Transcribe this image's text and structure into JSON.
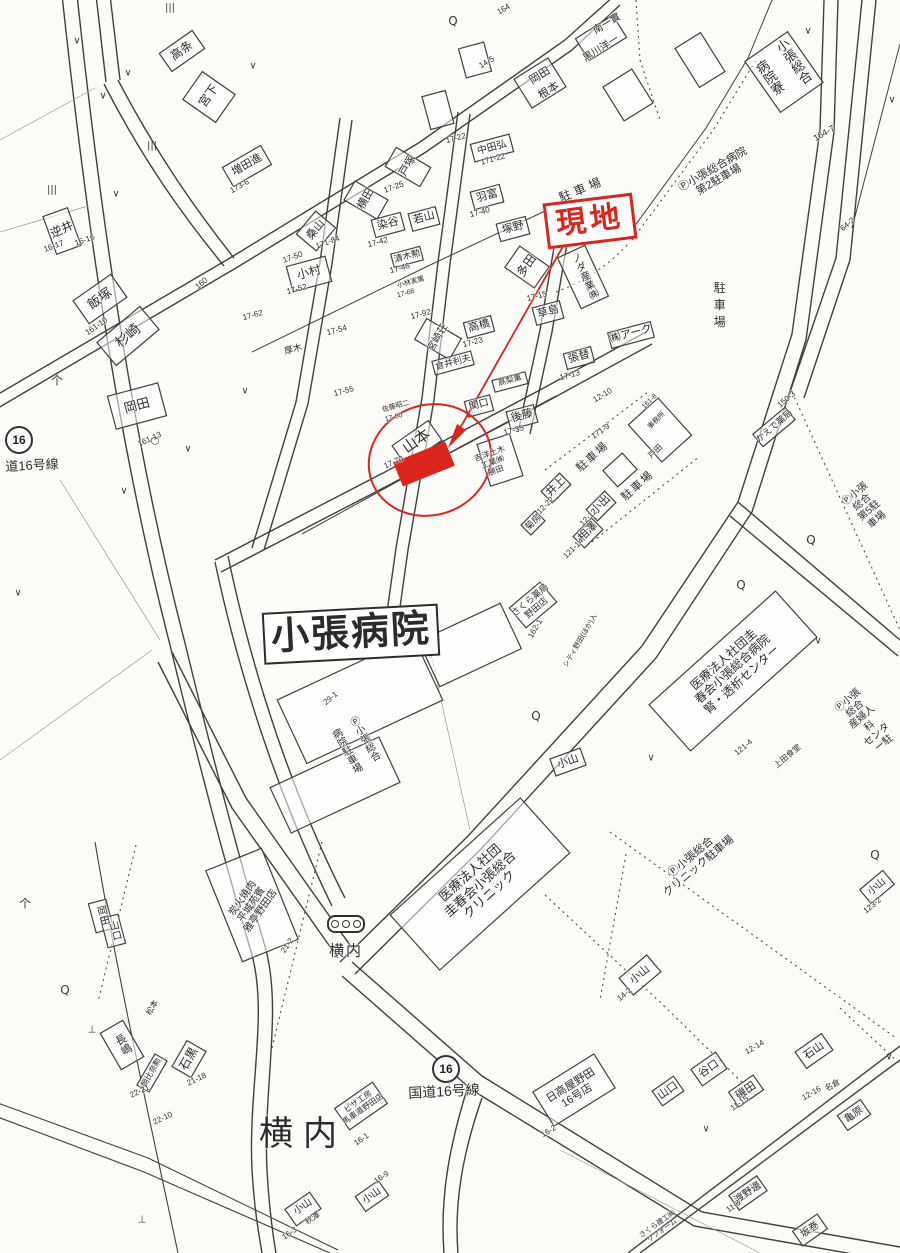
{
  "title": "住宅地図(案内図) 現地周辺図",
  "colors": {
    "annotation_red": "#d9251c",
    "line": "#3f3f3c",
    "paper": "#fbfbf8"
  },
  "annotation": {
    "site_label": "現地"
  },
  "roads": {
    "route_shield": "16",
    "route_label_bottom": "国道16号線",
    "route_label_left": "道16号線"
  },
  "map": {
    "labels": [
      {
        "t": "飯塚",
        "x": 100,
        "y": 299,
        "s": 13,
        "r": -35
      },
      {
        "t": "161-10",
        "x": 97,
        "y": 327,
        "s": 8,
        "r": -35
      },
      {
        "t": "岡田",
        "x": 137,
        "y": 406,
        "s": 13,
        "r": -15
      },
      {
        "t": "161-13",
        "x": 150,
        "y": 440,
        "s": 8,
        "r": -25
      },
      {
        "t": "高条",
        "x": 182,
        "y": 51,
        "s": 12,
        "r": -35
      },
      {
        "t": "宮下",
        "x": 209,
        "y": 96,
        "s": 12,
        "r": -55
      },
      {
        "t": "増田進",
        "x": 247,
        "y": 165,
        "s": 11,
        "r": -30
      },
      {
        "t": "173-6",
        "x": 240,
        "y": 187,
        "s": 8,
        "r": -30
      },
      {
        "t": "逆井",
        "x": 62,
        "y": 230,
        "s": 12,
        "r": -25
      },
      {
        "t": "16-17",
        "x": 54,
        "y": 247,
        "s": 8,
        "r": -20
      },
      {
        "t": "16-16",
        "x": 85,
        "y": 241,
        "s": 8,
        "r": -20
      },
      {
        "t": "杉崎",
        "x": 128,
        "y": 336,
        "s": 14,
        "r": -40
      },
      {
        "t": "160",
        "x": 202,
        "y": 284,
        "s": 8,
        "r": -40
      },
      {
        "t": "164",
        "x": 504,
        "y": 10,
        "s": 8,
        "r": -30
      },
      {
        "t": "南一實",
        "x": 607,
        "y": 24,
        "s": 10,
        "r": -32
      },
      {
        "t": "黒川洋一",
        "x": 601,
        "y": 49,
        "s": 10,
        "r": -32
      },
      {
        "t": "岡田",
        "x": 540,
        "y": 76,
        "s": 11,
        "r": -32
      },
      {
        "t": "根本",
        "x": 549,
        "y": 91,
        "s": 11,
        "r": -32
      },
      {
        "t": "14-5",
        "x": 487,
        "y": 63,
        "s": 8,
        "r": -30
      },
      {
        "t": "17-22",
        "x": 456,
        "y": 139,
        "s": 8,
        "r": -15
      },
      {
        "t": "中田弘",
        "x": 492,
        "y": 148,
        "s": 10,
        "r": -15
      },
      {
        "t": "171-22",
        "x": 493,
        "y": 160,
        "s": 8,
        "r": -15
      },
      {
        "t": "戸塚",
        "x": 408,
        "y": 166,
        "s": 11,
        "r": -60
      },
      {
        "t": "17-25",
        "x": 394,
        "y": 188,
        "s": 8,
        "r": -20
      },
      {
        "t": "横田",
        "x": 366,
        "y": 199,
        "s": 11,
        "r": -60
      },
      {
        "t": "桑山",
        "x": 316,
        "y": 230,
        "s": 11,
        "r": -50
      },
      {
        "t": "17-50",
        "x": 293,
        "y": 258,
        "s": 8,
        "r": -20
      },
      {
        "t": "171-84",
        "x": 328,
        "y": 243,
        "s": 8,
        "r": -20
      },
      {
        "t": "染谷",
        "x": 388,
        "y": 224,
        "s": 11,
        "r": -15
      },
      {
        "t": "17-42",
        "x": 378,
        "y": 243,
        "s": 8,
        "r": -15
      },
      {
        "t": "若山",
        "x": 424,
        "y": 218,
        "s": 11,
        "r": -15
      },
      {
        "t": "羽富",
        "x": 487,
        "y": 196,
        "s": 11,
        "r": -15
      },
      {
        "t": "17-40",
        "x": 480,
        "y": 213,
        "s": 8,
        "r": -15
      },
      {
        "t": "塚野",
        "x": 513,
        "y": 228,
        "s": 11,
        "r": -15
      },
      {
        "t": "清木勲",
        "x": 407,
        "y": 256,
        "s": 9,
        "r": -15
      },
      {
        "t": "17-46",
        "x": 400,
        "y": 269,
        "s": 8,
        "r": -15
      },
      {
        "t": "小村",
        "x": 309,
        "y": 273,
        "s": 12,
        "r": -15
      },
      {
        "t": "17-52",
        "x": 297,
        "y": 290,
        "s": 8,
        "r": -15
      },
      {
        "t": "小林実篤",
        "x": 411,
        "y": 283,
        "s": 7,
        "r": -15
      },
      {
        "t": "17-68",
        "x": 406,
        "y": 294,
        "s": 7,
        "r": -15
      },
      {
        "t": "多田",
        "x": 527,
        "y": 266,
        "s": 12,
        "r": -55
      },
      {
        "t": "駐車場",
        "x": 582,
        "y": 190,
        "s": 12,
        "r": -22,
        "ls": 4
      },
      {
        "t": "17-62",
        "x": 253,
        "y": 316,
        "s": 8,
        "r": -15
      },
      {
        "t": "17-54",
        "x": 337,
        "y": 331,
        "s": 8,
        "r": -15
      },
      {
        "t": "17-92",
        "x": 421,
        "y": 315,
        "s": 8,
        "r": -15
      },
      {
        "t": "17-55",
        "x": 344,
        "y": 392,
        "s": 8,
        "r": -15
      },
      {
        "t": "厚木",
        "x": 293,
        "y": 349,
        "s": 9,
        "r": -15
      },
      {
        "t": "ノダ産業㈱",
        "x": 583,
        "y": 277,
        "s": 10,
        "r": -25,
        "v": 1
      },
      {
        "t": "草島",
        "x": 548,
        "y": 312,
        "s": 11,
        "r": -15
      },
      {
        "t": "17-15",
        "x": 537,
        "y": 297,
        "s": 8,
        "r": -15
      },
      {
        "t": "宮崎荘",
        "x": 438,
        "y": 338,
        "s": 10,
        "r": -60
      },
      {
        "t": "高橋",
        "x": 479,
        "y": 326,
        "s": 11,
        "r": -15
      },
      {
        "t": "17-23",
        "x": 473,
        "y": 343,
        "s": 8,
        "r": -15
      },
      {
        "t": "倉井利夫",
        "x": 453,
        "y": 362,
        "s": 9,
        "r": -15
      },
      {
        "t": "張替",
        "x": 579,
        "y": 357,
        "s": 11,
        "r": -15
      },
      {
        "t": "17-13",
        "x": 570,
        "y": 376,
        "s": 8,
        "r": -15
      },
      {
        "t": "㈱アーク",
        "x": 631,
        "y": 334,
        "s": 11,
        "r": -15
      },
      {
        "t": "高梨薫",
        "x": 510,
        "y": 381,
        "s": 8,
        "r": -15
      },
      {
        "t": "関口",
        "x": 479,
        "y": 405,
        "s": 10,
        "r": -15
      },
      {
        "t": "後藤",
        "x": 522,
        "y": 416,
        "s": 11,
        "r": -15
      },
      {
        "t": "17-35",
        "x": 514,
        "y": 431,
        "s": 8,
        "r": -15
      },
      {
        "t": "佐藤昭二",
        "x": 396,
        "y": 407,
        "s": 7,
        "r": -15
      },
      {
        "t": "17-80",
        "x": 394,
        "y": 418,
        "s": 7,
        "r": -15
      },
      {
        "t": "山本",
        "x": 417,
        "y": 442,
        "s": 15,
        "r": -35
      },
      {
        "t": "17-70",
        "x": 394,
        "y": 463,
        "s": 8,
        "r": -25
      },
      {
        "t": "吉洋土木\n工業㈱\n勝田",
        "x": 493,
        "y": 463,
        "s": 8,
        "r": -20
      },
      {
        "t": "12-10",
        "x": 603,
        "y": 396,
        "s": 8,
        "r": -30
      },
      {
        "t": "171-9",
        "x": 601,
        "y": 432,
        "s": 8,
        "r": -35
      },
      {
        "t": "161-8",
        "x": 650,
        "y": 402,
        "s": 7,
        "r": -45
      },
      {
        "t": "事務所",
        "x": 657,
        "y": 421,
        "s": 7,
        "r": -45
      },
      {
        "t": "戸田",
        "x": 656,
        "y": 452,
        "s": 8,
        "r": -45
      },
      {
        "t": "駐車場",
        "x": 593,
        "y": 457,
        "s": 11,
        "r": -42,
        "ls": 2
      },
      {
        "t": "駐車場",
        "x": 638,
        "y": 486,
        "s": 11,
        "r": -42,
        "ls": 2
      },
      {
        "t": "井上",
        "x": 556,
        "y": 487,
        "s": 11,
        "r": -45
      },
      {
        "t": "12-22",
        "x": 546,
        "y": 506,
        "s": 8,
        "r": -45
      },
      {
        "t": "小出",
        "x": 601,
        "y": 505,
        "s": 11,
        "r": -45
      },
      {
        "t": "12-12",
        "x": 589,
        "y": 518,
        "s": 8,
        "r": -45
      },
      {
        "t": "相澤",
        "x": 588,
        "y": 532,
        "s": 11,
        "r": -45
      },
      {
        "t": "121-14",
        "x": 574,
        "y": 549,
        "s": 8,
        "r": -45
      },
      {
        "t": "菊房",
        "x": 533,
        "y": 522,
        "s": 9,
        "r": -45
      },
      {
        "t": "かえで薬局",
        "x": 774,
        "y": 426,
        "s": 9,
        "r": -40
      },
      {
        "t": "150-3",
        "x": 787,
        "y": 400,
        "s": 8,
        "r": -40
      },
      {
        "t": "Ⓟ小張総合\n第5駐車場",
        "x": 866,
        "y": 507,
        "s": 10,
        "r": -40
      },
      {
        "t": "64-2",
        "x": 848,
        "y": 225,
        "s": 8,
        "r": -40
      },
      {
        "t": "小張総合",
        "x": 793,
        "y": 62,
        "s": 13,
        "r": -35,
        "v": 1
      },
      {
        "t": "病院寮",
        "x": 769,
        "y": 78,
        "s": 13,
        "r": -35,
        "v": 1
      },
      {
        "t": "164-7",
        "x": 824,
        "y": 133,
        "s": 9,
        "r": -30
      },
      {
        "t": "Ⓟ小張総合病院\n第2駐車場",
        "x": 716,
        "y": 175,
        "s": 11,
        "r": -30
      },
      {
        "t": "駐車場",
        "x": 719,
        "y": 307,
        "s": 12,
        "r": 0,
        "v": 1,
        "ls": 5
      },
      {
        "t": "現地",
        "x": 590,
        "y": 221,
        "s": 30,
        "r": -7,
        "c": "red",
        "b": 1,
        "box": 1,
        "ls": 4
      },
      {
        "t": "小張病院",
        "x": 351,
        "y": 634,
        "s": 38,
        "r": -3,
        "b": 1,
        "box": 1,
        "ls": 2
      },
      {
        "t": "Ⓟ小張総合",
        "x": 363,
        "y": 740,
        "s": 10,
        "r": -30,
        "v": 1
      },
      {
        "t": "病院駐車場",
        "x": 345,
        "y": 752,
        "s": 10,
        "r": -30,
        "v": 1
      },
      {
        "t": "さくら薬局\n野田店",
        "x": 533,
        "y": 604,
        "s": 9,
        "r": -40
      },
      {
        "t": "162-1",
        "x": 536,
        "y": 629,
        "s": 8,
        "r": -60
      },
      {
        "t": "シティ野田(ほか)入",
        "x": 581,
        "y": 641,
        "s": 7,
        "r": -60
      },
      {
        "t": "医療法人社団圭\n春会小張総合病院\n腎・透析センター",
        "x": 733,
        "y": 670,
        "s": 12,
        "r": -42
      },
      {
        "t": "121-4",
        "x": 744,
        "y": 748,
        "s": 8,
        "r": -40
      },
      {
        "t": "上田食堂",
        "x": 788,
        "y": 757,
        "s": 8,
        "r": -40
      },
      {
        "t": "Ⓟ小張総合\n産婦人科\nセンター駐",
        "x": 866,
        "y": 722,
        "s": 10,
        "r": -40
      },
      {
        "t": "小山",
        "x": 568,
        "y": 762,
        "s": 11,
        "r": -20
      },
      {
        "t": "29-1",
        "x": 331,
        "y": 699,
        "s": 8,
        "r": -40
      },
      {
        "t": "医療法人社団\n圭春会小張総合\nクリニック",
        "x": 480,
        "y": 884,
        "s": 13,
        "r": -42
      },
      {
        "t": "Ⓟ小張総合\nクリニック駐車場",
        "x": 695,
        "y": 862,
        "s": 11,
        "r": -40
      },
      {
        "t": "小山",
        "x": 640,
        "y": 975,
        "s": 11,
        "r": -40
      },
      {
        "t": "14-2",
        "x": 625,
        "y": 995,
        "s": 8,
        "r": -40
      },
      {
        "t": "小山",
        "x": 877,
        "y": 887,
        "s": 10,
        "r": -40
      },
      {
        "t": "123-2",
        "x": 873,
        "y": 906,
        "s": 8,
        "r": -40
      },
      {
        "t": "横内",
        "x": 346,
        "y": 952,
        "s": 15,
        "r": 0,
        "ls": 2
      },
      {
        "t": "横内",
        "x": 303,
        "y": 1134,
        "s": 34,
        "r": 0,
        "ls": 10
      },
      {
        "t": "炭火焼肉\n平城苑賓\n雅亭野田店",
        "x": 252,
        "y": 905,
        "s": 10,
        "r": -55
      },
      {
        "t": "21-2",
        "x": 288,
        "y": 946,
        "s": 8,
        "r": -55
      },
      {
        "t": "岡田",
        "x": 101,
        "y": 916,
        "s": 10,
        "r": -15,
        "v": 1
      },
      {
        "t": "山口",
        "x": 113,
        "y": 931,
        "s": 10,
        "r": -15,
        "v": 1
      },
      {
        "t": "長嶋",
        "x": 122,
        "y": 1045,
        "s": 11,
        "r": -30,
        "v": 1
      },
      {
        "t": "松本",
        "x": 153,
        "y": 1008,
        "s": 8,
        "r": -60
      },
      {
        "t": "石黒",
        "x": 189,
        "y": 1059,
        "s": 12,
        "r": -60
      },
      {
        "t": "21-18",
        "x": 197,
        "y": 1080,
        "s": 8,
        "r": -25
      },
      {
        "t": "朝比奈勲",
        "x": 152,
        "y": 1073,
        "s": 8,
        "r": -60
      },
      {
        "t": "22-21",
        "x": 140,
        "y": 1092,
        "s": 8,
        "r": -25
      },
      {
        "t": "22-10",
        "x": 163,
        "y": 1119,
        "s": 8,
        "r": -25
      },
      {
        "t": "ピザ工房\n馬車道野田店",
        "x": 361,
        "y": 1106,
        "s": 8,
        "r": -35
      },
      {
        "t": "16-1",
        "x": 362,
        "y": 1140,
        "s": 8,
        "r": -35
      },
      {
        "t": "小山",
        "x": 303,
        "y": 1207,
        "s": 10,
        "r": -35
      },
      {
        "t": "秋澤",
        "x": 313,
        "y": 1219,
        "s": 8,
        "r": -35
      },
      {
        "t": "16-3",
        "x": 290,
        "y": 1234,
        "s": 8,
        "r": -35
      },
      {
        "t": "小山",
        "x": 372,
        "y": 1196,
        "s": 10,
        "r": -35
      },
      {
        "t": "16-9",
        "x": 382,
        "y": 1178,
        "s": 8,
        "r": -35
      },
      {
        "t": "国道16号線",
        "x": 444,
        "y": 1092,
        "s": 14,
        "r": -3
      },
      {
        "t": "道16号線",
        "x": 32,
        "y": 466,
        "s": 13,
        "r": -3
      },
      {
        "t": "日高屋野田\n16号店",
        "x": 574,
        "y": 1091,
        "s": 11,
        "r": -32
      },
      {
        "t": "16-2",
        "x": 549,
        "y": 1132,
        "s": 8,
        "r": -32
      },
      {
        "t": "山口",
        "x": 668,
        "y": 1091,
        "s": 11,
        "r": -35
      },
      {
        "t": "谷口",
        "x": 709,
        "y": 1069,
        "s": 11,
        "r": -35
      },
      {
        "t": "磯田",
        "x": 746,
        "y": 1091,
        "s": 11,
        "r": -35
      },
      {
        "t": "11-15",
        "x": 740,
        "y": 1104,
        "s": 8,
        "r": -35
      },
      {
        "t": "石山",
        "x": 814,
        "y": 1051,
        "s": 11,
        "r": -35
      },
      {
        "t": "12-14",
        "x": 755,
        "y": 1048,
        "s": 8,
        "r": -30
      },
      {
        "t": "12-16",
        "x": 812,
        "y": 1094,
        "s": 8,
        "r": -30
      },
      {
        "t": "名倉",
        "x": 833,
        "y": 1086,
        "s": 8,
        "r": -30
      },
      {
        "t": "亀原",
        "x": 854,
        "y": 1115,
        "s": 10,
        "r": -35
      },
      {
        "t": "渡野邊",
        "x": 748,
        "y": 1193,
        "s": 10,
        "r": -35
      },
      {
        "t": "11-6",
        "x": 734,
        "y": 1207,
        "s": 8,
        "r": -35
      },
      {
        "t": "坂巻",
        "x": 810,
        "y": 1230,
        "s": 10,
        "r": -35
      },
      {
        "t": "さくら建工㈱\nリフォーム",
        "x": 660,
        "y": 1228,
        "s": 7,
        "r": -35
      }
    ],
    "symbols": [
      {
        "g": "Q",
        "x": 453,
        "y": 21
      },
      {
        "g": "Q",
        "x": 65,
        "y": 990
      },
      {
        "g": "Q",
        "x": 741,
        "y": 585
      },
      {
        "g": "Q",
        "x": 811,
        "y": 540
      },
      {
        "g": "Q",
        "x": 536,
        "y": 716
      },
      {
        "g": "Q",
        "x": 875,
        "y": 855
      },
      {
        "g": "∨",
        "x": 77,
        "y": 41
      },
      {
        "g": "∨",
        "x": 128,
        "y": 73
      },
      {
        "g": "∨",
        "x": 103,
        "y": 96
      },
      {
        "g": "∨",
        "x": 253,
        "y": 66
      },
      {
        "g": "∨",
        "x": 116,
        "y": 194
      },
      {
        "g": "∨",
        "x": 188,
        "y": 449
      },
      {
        "g": "∨",
        "x": 124,
        "y": 491
      },
      {
        "g": "∨",
        "x": 18,
        "y": 593
      },
      {
        "g": "∨",
        "x": 245,
        "y": 391
      },
      {
        "g": "∨",
        "x": 808,
        "y": 31
      },
      {
        "g": "∨",
        "x": 818,
        "y": 641
      },
      {
        "g": "∨",
        "x": 651,
        "y": 758
      },
      {
        "g": "∨",
        "x": 889,
        "y": 1057
      },
      {
        "g": "∨",
        "x": 706,
        "y": 1129
      },
      {
        "g": "∨",
        "x": 892,
        "y": 100
      },
      {
        "g": "⊥",
        "x": 92,
        "y": 1030
      },
      {
        "g": "⊥",
        "x": 142,
        "y": 1220
      },
      {
        "g": "个",
        "x": 57,
        "y": 380
      },
      {
        "g": "个",
        "x": 25,
        "y": 903
      },
      {
        "g": "|||",
        "x": 170,
        "y": 8
      },
      {
        "g": "|||",
        "x": 152,
        "y": 146
      },
      {
        "g": "|||",
        "x": 52,
        "y": 190
      },
      {
        "g": "○",
        "x": 155,
        "y": 441
      }
    ]
  }
}
